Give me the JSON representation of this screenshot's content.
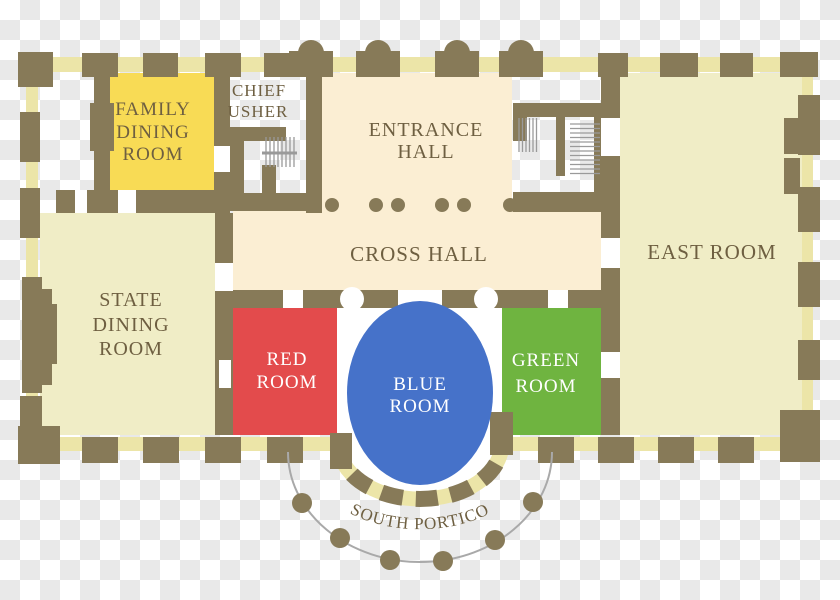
{
  "plan": {
    "rooms": {
      "family_dining": {
        "lines": [
          "FAMILY",
          "DINING",
          "ROOM"
        ],
        "color": "#f8db55"
      },
      "chief_usher": {
        "lines": [
          "CHIEF",
          "USHER"
        ]
      },
      "entrance_hall": {
        "lines": [
          "ENTRANCE",
          "HALL"
        ]
      },
      "cross_hall": {
        "label": "CROSS HALL"
      },
      "east_room": {
        "label": "EAST ROOM"
      },
      "state_dining_room": {
        "lines": [
          "STATE",
          "DINING",
          "ROOM"
        ]
      },
      "red_room": {
        "lines": [
          "RED",
          "ROOM"
        ],
        "color": "#e34b4c"
      },
      "blue_room": {
        "lines": [
          "BLUE",
          "ROOM"
        ],
        "color": "#4672c9"
      },
      "green_room": {
        "lines": [
          "GREEN",
          "ROOM"
        ],
        "color": "#6fb440"
      }
    },
    "portico": {
      "label": "SOUTH PORTICO"
    },
    "colors": {
      "wall": "#877a58",
      "window_strip": "#ece5a8",
      "hall_floor": "#fbeed3",
      "room_floor": "#f0edc6",
      "label_text": "#6e5f41",
      "room_label_text": "#ffffff",
      "portico_line": "#a9a9a9",
      "stair_line": "#9a9a9a",
      "floor_white": "#ffffff"
    }
  }
}
